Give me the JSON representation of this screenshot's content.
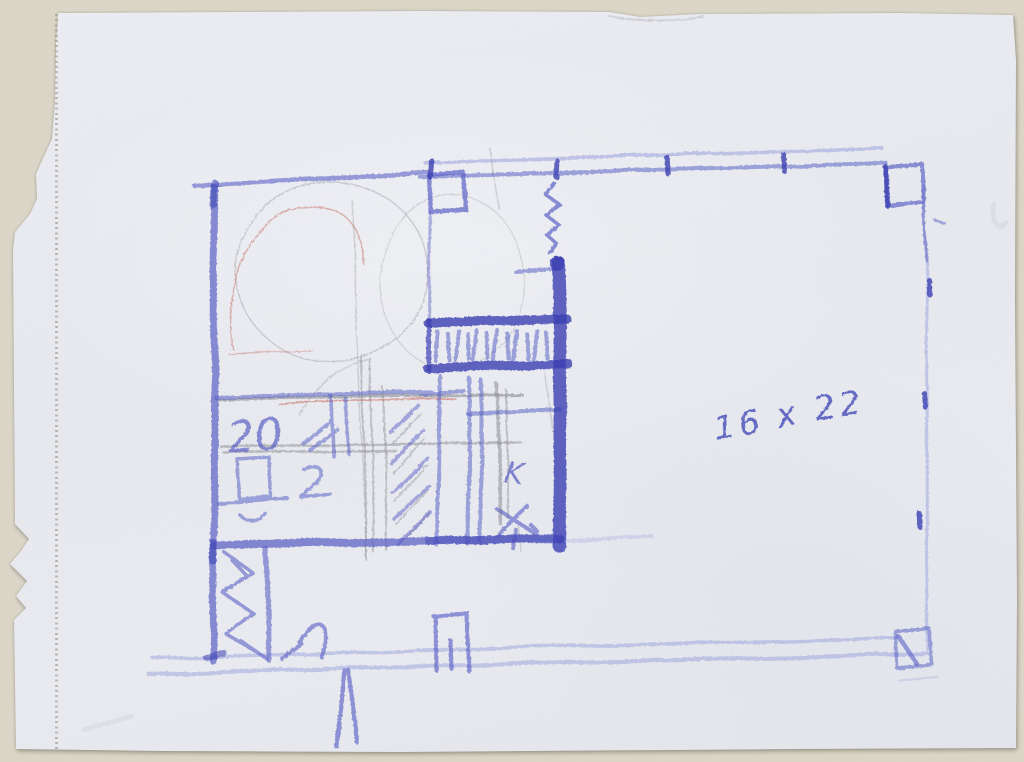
{
  "document": {
    "description": "Hand-drawn floor plan sketch in blue crayon and pencil on torn perforated notebook paper",
    "annotations": {
      "dimension_label": "16 x 22",
      "room_label": "K",
      "number_label": "20"
    },
    "colors": {
      "scan_background": "#dbd6c7",
      "paper": "#e7e9ef",
      "crayon_blue": "#5a60c4",
      "crayon_blue_dark": "#3b40b2",
      "crayon_blue_light": "#9aa0dc",
      "ink_blue": "#464cb8",
      "pencil_gray": "#8b8b90",
      "red_pencil": "#c9736c",
      "perforation": "#96917f"
    }
  }
}
